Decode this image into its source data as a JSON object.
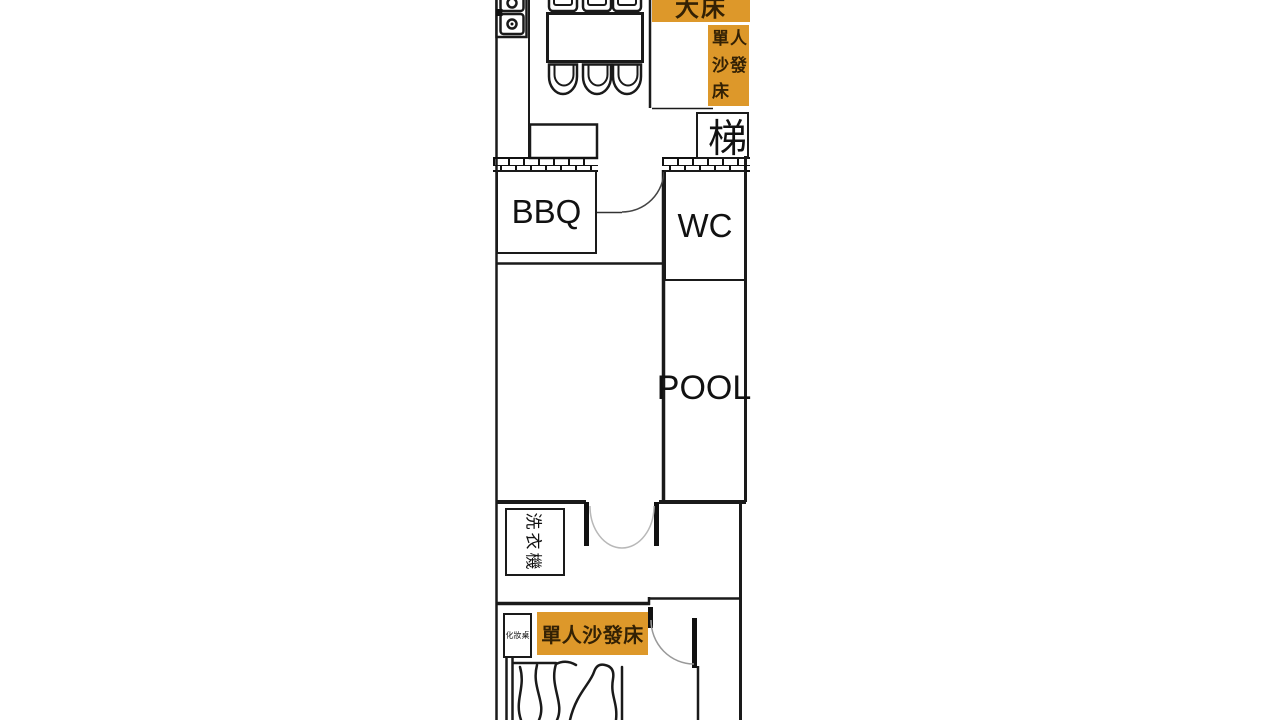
{
  "palette": {
    "highlight": "#DD982A",
    "highlight_text": "#332104",
    "wall": "#1a1a1a",
    "door_arc": "#999999"
  },
  "floorplan": {
    "rooms": {
      "bbq": "BBQ",
      "wc": "WC",
      "pool": "POOL",
      "stairs": "梯",
      "washer": "洗衣機",
      "makeup_table": "化妝桌"
    },
    "bed_labels": {
      "double_bed": "大床",
      "sofa_bed_upper": "單人沙發床",
      "sofa_bed_lower": "單人沙發床"
    }
  }
}
